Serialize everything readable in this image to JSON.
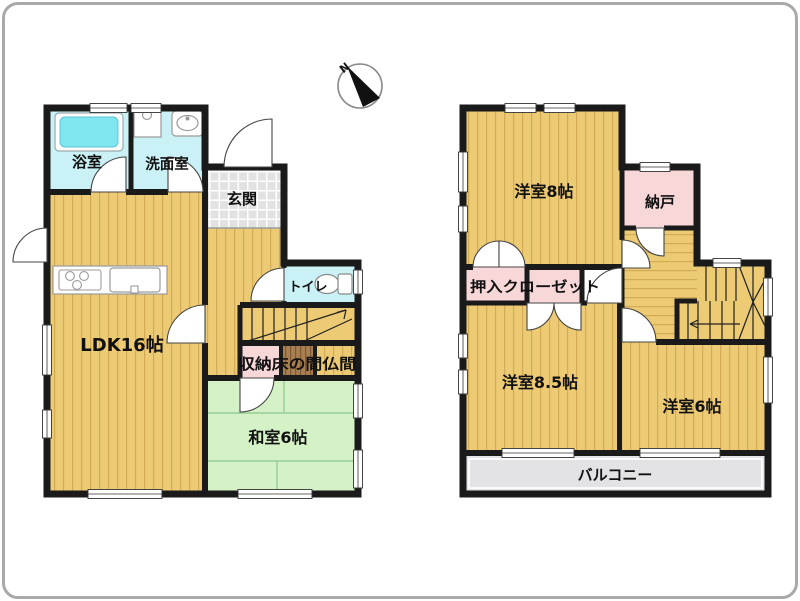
{
  "compass": {
    "label": "N"
  },
  "floor1": {
    "bath": "浴室",
    "washroom": "洗面室",
    "entrance": "玄関",
    "ldk": "LDK16帖",
    "toilet": "トイレ",
    "storage": "収納床の間仏間",
    "washitsu": "和室6帖"
  },
  "floor2": {
    "room8": "洋室8帖",
    "nando": "納戸",
    "closet": "押入クローゼット",
    "room85": "洋室8.5帖",
    "room6": "洋室6帖",
    "balcony": "バルコニー"
  },
  "colors": {
    "wood_floor": "#edca74",
    "wood_stripe": "#d3ab55",
    "tatami": "#d4f2c6",
    "tatami_line": "#96cc96",
    "water_room": "#c9f1f6",
    "bathtub": "#7fe6ef",
    "pink_storage": "#f8d7d9",
    "tokonoma_brown": "#a87f52",
    "entrance_tile": "#e2e2e2",
    "balcony_gray": "#e3e3e5",
    "wall": "#1a1a1a",
    "frame_border": "#a9a9a9"
  }
}
